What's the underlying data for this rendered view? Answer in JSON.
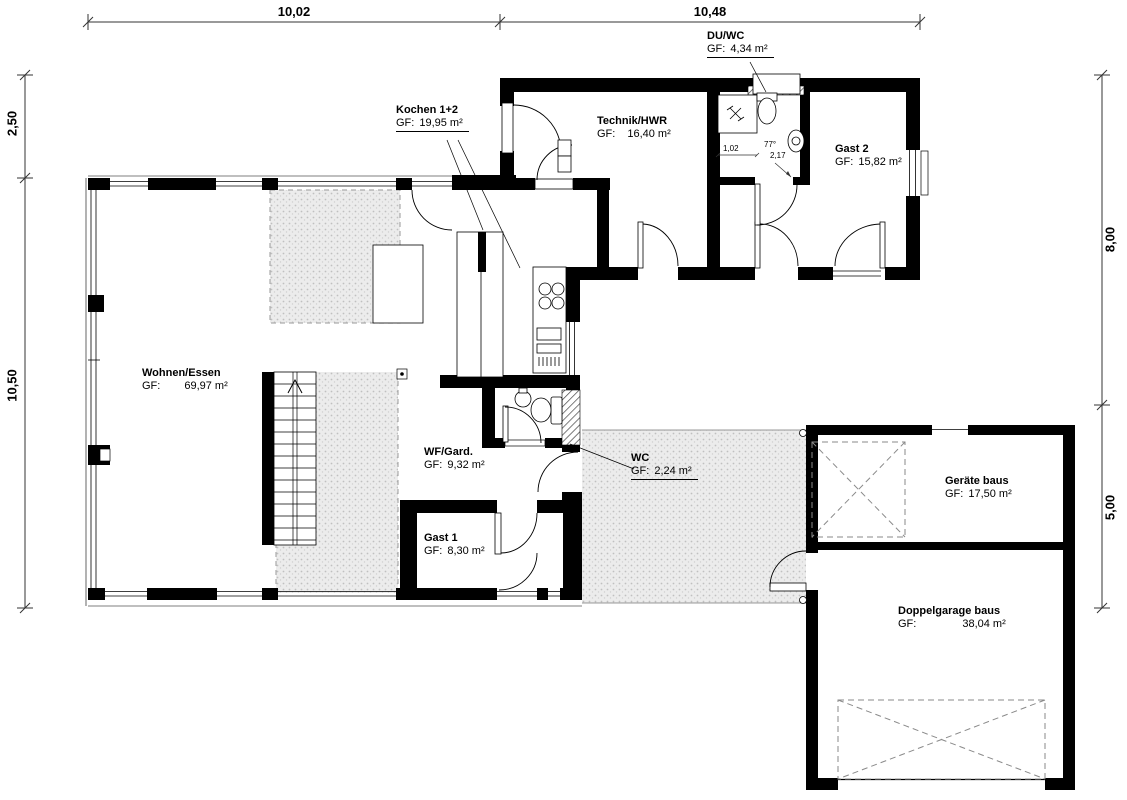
{
  "dims": {
    "top1": "10,02",
    "top2": "10,48",
    "left1": "2,50",
    "left2": "10,50",
    "right1": "8,00",
    "right2": "5,00",
    "door_width": "1,02",
    "door_angle": "77°",
    "door_clear": "2,17"
  },
  "rooms": {
    "kochen": {
      "name": "Kochen 1+2",
      "gf": "GF:",
      "area": "19,95 m²"
    },
    "duwc": {
      "name": "DU/WC",
      "gf": "GF:",
      "area": "4,34 m²"
    },
    "technik": {
      "name": "Technik/HWR",
      "gf": "GF:",
      "area": "16,40 m²"
    },
    "gast2": {
      "name": "Gast 2",
      "gf": "GF:",
      "area": "15,82 m²"
    },
    "wohnen": {
      "name": "Wohnen/Essen",
      "gf": "GF:",
      "area": "69,97 m²"
    },
    "wfgard": {
      "name": "WF/Gard.",
      "gf": "GF:",
      "area": "9,32 m²"
    },
    "wc": {
      "name": "WC",
      "gf": "GF:",
      "area": "2,24 m²"
    },
    "gast1": {
      "name": "Gast 1",
      "gf": "GF:",
      "area": "8,30 m²"
    },
    "geraete": {
      "name": "Geräte baus",
      "gf": "GF:",
      "area": "17,50 m²"
    },
    "garage": {
      "name": "Doppelgarage baus",
      "gf": "GF:",
      "area": "38,04 m²"
    }
  },
  "colors": {
    "wall": "#000000",
    "stipple_bg": "#ececec",
    "dashed": "#8a8a8a"
  }
}
